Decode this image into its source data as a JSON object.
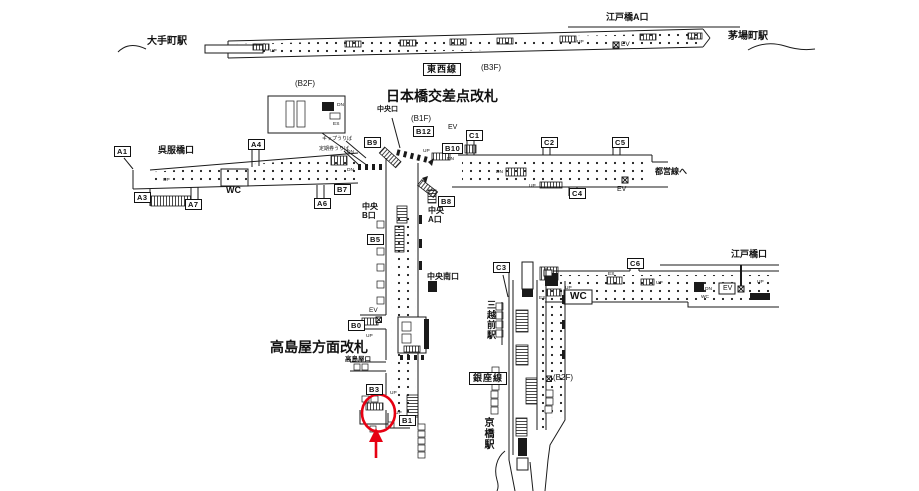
{
  "colors": {
    "ink": "#1a1a1a",
    "red": "#e60012",
    "bg": "#ffffff"
  },
  "stations": {
    "otemachi": "大手町駅",
    "kayabacho": "茅場町駅",
    "mitsukoshimae": "三越前駅",
    "kyobashi": "京橋駅"
  },
  "lines": {
    "tozai": "東西線",
    "ginza": "銀座線"
  },
  "gates": {
    "nihombashi": "日本橋交差点改札",
    "takashimaya": "高島屋方面改札"
  },
  "floors": {
    "b1f": "(B1F)",
    "b2f": "(B2F)",
    "b3f": "(B3F)"
  },
  "entrances": {
    "edobashi_a": "江戸橋A口",
    "gofukubashi": "呉服橋口",
    "chuo": "中央口",
    "chuo_b1": "中央",
    "chuo_b2": "B口",
    "chuo_a1": "中央",
    "chuo_a2": "A口",
    "chuo_minami": "中央南口",
    "takashimaya": "高島屋口",
    "edobashi": "江戸橋口",
    "toei": "都営線へ"
  },
  "exits": {
    "a1": "A1",
    "a3": "A3",
    "a4": "A4",
    "a6": "A6",
    "a7": "A7",
    "b0": "B0",
    "b1": "B1",
    "b3": "B3",
    "b5": "B5",
    "b7": "B7",
    "b8": "B8",
    "b9": "B9",
    "b10": "B10",
    "b12": "B12",
    "c1": "C1",
    "c2": "C2",
    "c3": "C3",
    "c4": "C4",
    "c5": "C5",
    "c6": "C6"
  },
  "facilities": {
    "wc": "WC",
    "ev": "EV",
    "up": "UP",
    "dn": "DN",
    "es": "ES",
    "ticket_office": "キップうりば",
    "pass_office": "定期券うりば"
  }
}
